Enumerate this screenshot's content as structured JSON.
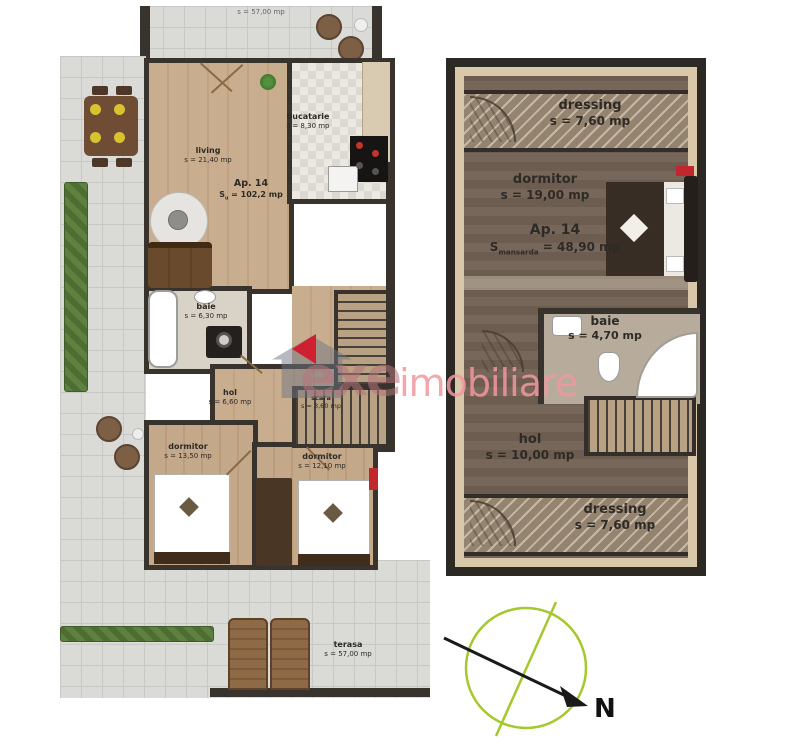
{
  "watermark": {
    "brand_prefix": "exe",
    "brand_suffix": "imobiliare"
  },
  "compass": {
    "north_label": "N"
  },
  "colors": {
    "accent_red": "#c1272d",
    "compass_green": "#a5c82d",
    "watermark_pink": "#ef96a0"
  },
  "floor_lower": {
    "terrace_top_area": "s = 57,00 mp",
    "apartment": {
      "label": "Ap. 14",
      "area_prefix": "S",
      "area_sub": "u",
      "area_value": "= 102,2 mp"
    },
    "rooms": {
      "living": {
        "name": "living",
        "area": "s = 21,40 mp"
      },
      "bucatarie": {
        "name": "bucatarie",
        "area": "s = 8,30 mp"
      },
      "baie": {
        "name": "baie",
        "area": "s = 6,30 mp"
      },
      "hol": {
        "name": "hol",
        "area": "s = 6,60 mp"
      },
      "scara": {
        "name": "scara",
        "area": "s = 3,60 mp"
      },
      "dormitor1": {
        "name": "dormitor",
        "area": "s = 13,50 mp"
      },
      "dormitor2": {
        "name": "dormitor",
        "area": "s = 12,10 mp"
      },
      "terasa": {
        "name": "terasa",
        "area": "s = 57,00 mp"
      }
    }
  },
  "floor_upper": {
    "apartment": {
      "label": "Ap. 14",
      "area_prefix": "S",
      "area_sub": "mansarda",
      "area_value": "= 48,90 mp"
    },
    "rooms": {
      "dressing_top": {
        "name": "dressing",
        "area": "s = 7,60 mp"
      },
      "dormitor": {
        "name": "dormitor",
        "area": "s = 19,00 mp"
      },
      "baie": {
        "name": "baie",
        "area": "s = 4,70 mp"
      },
      "hol": {
        "name": "hol",
        "area": "s = 10,00 mp"
      },
      "dressing_bottom": {
        "name": "dressing",
        "area": "s = 7,60 mp"
      }
    }
  }
}
